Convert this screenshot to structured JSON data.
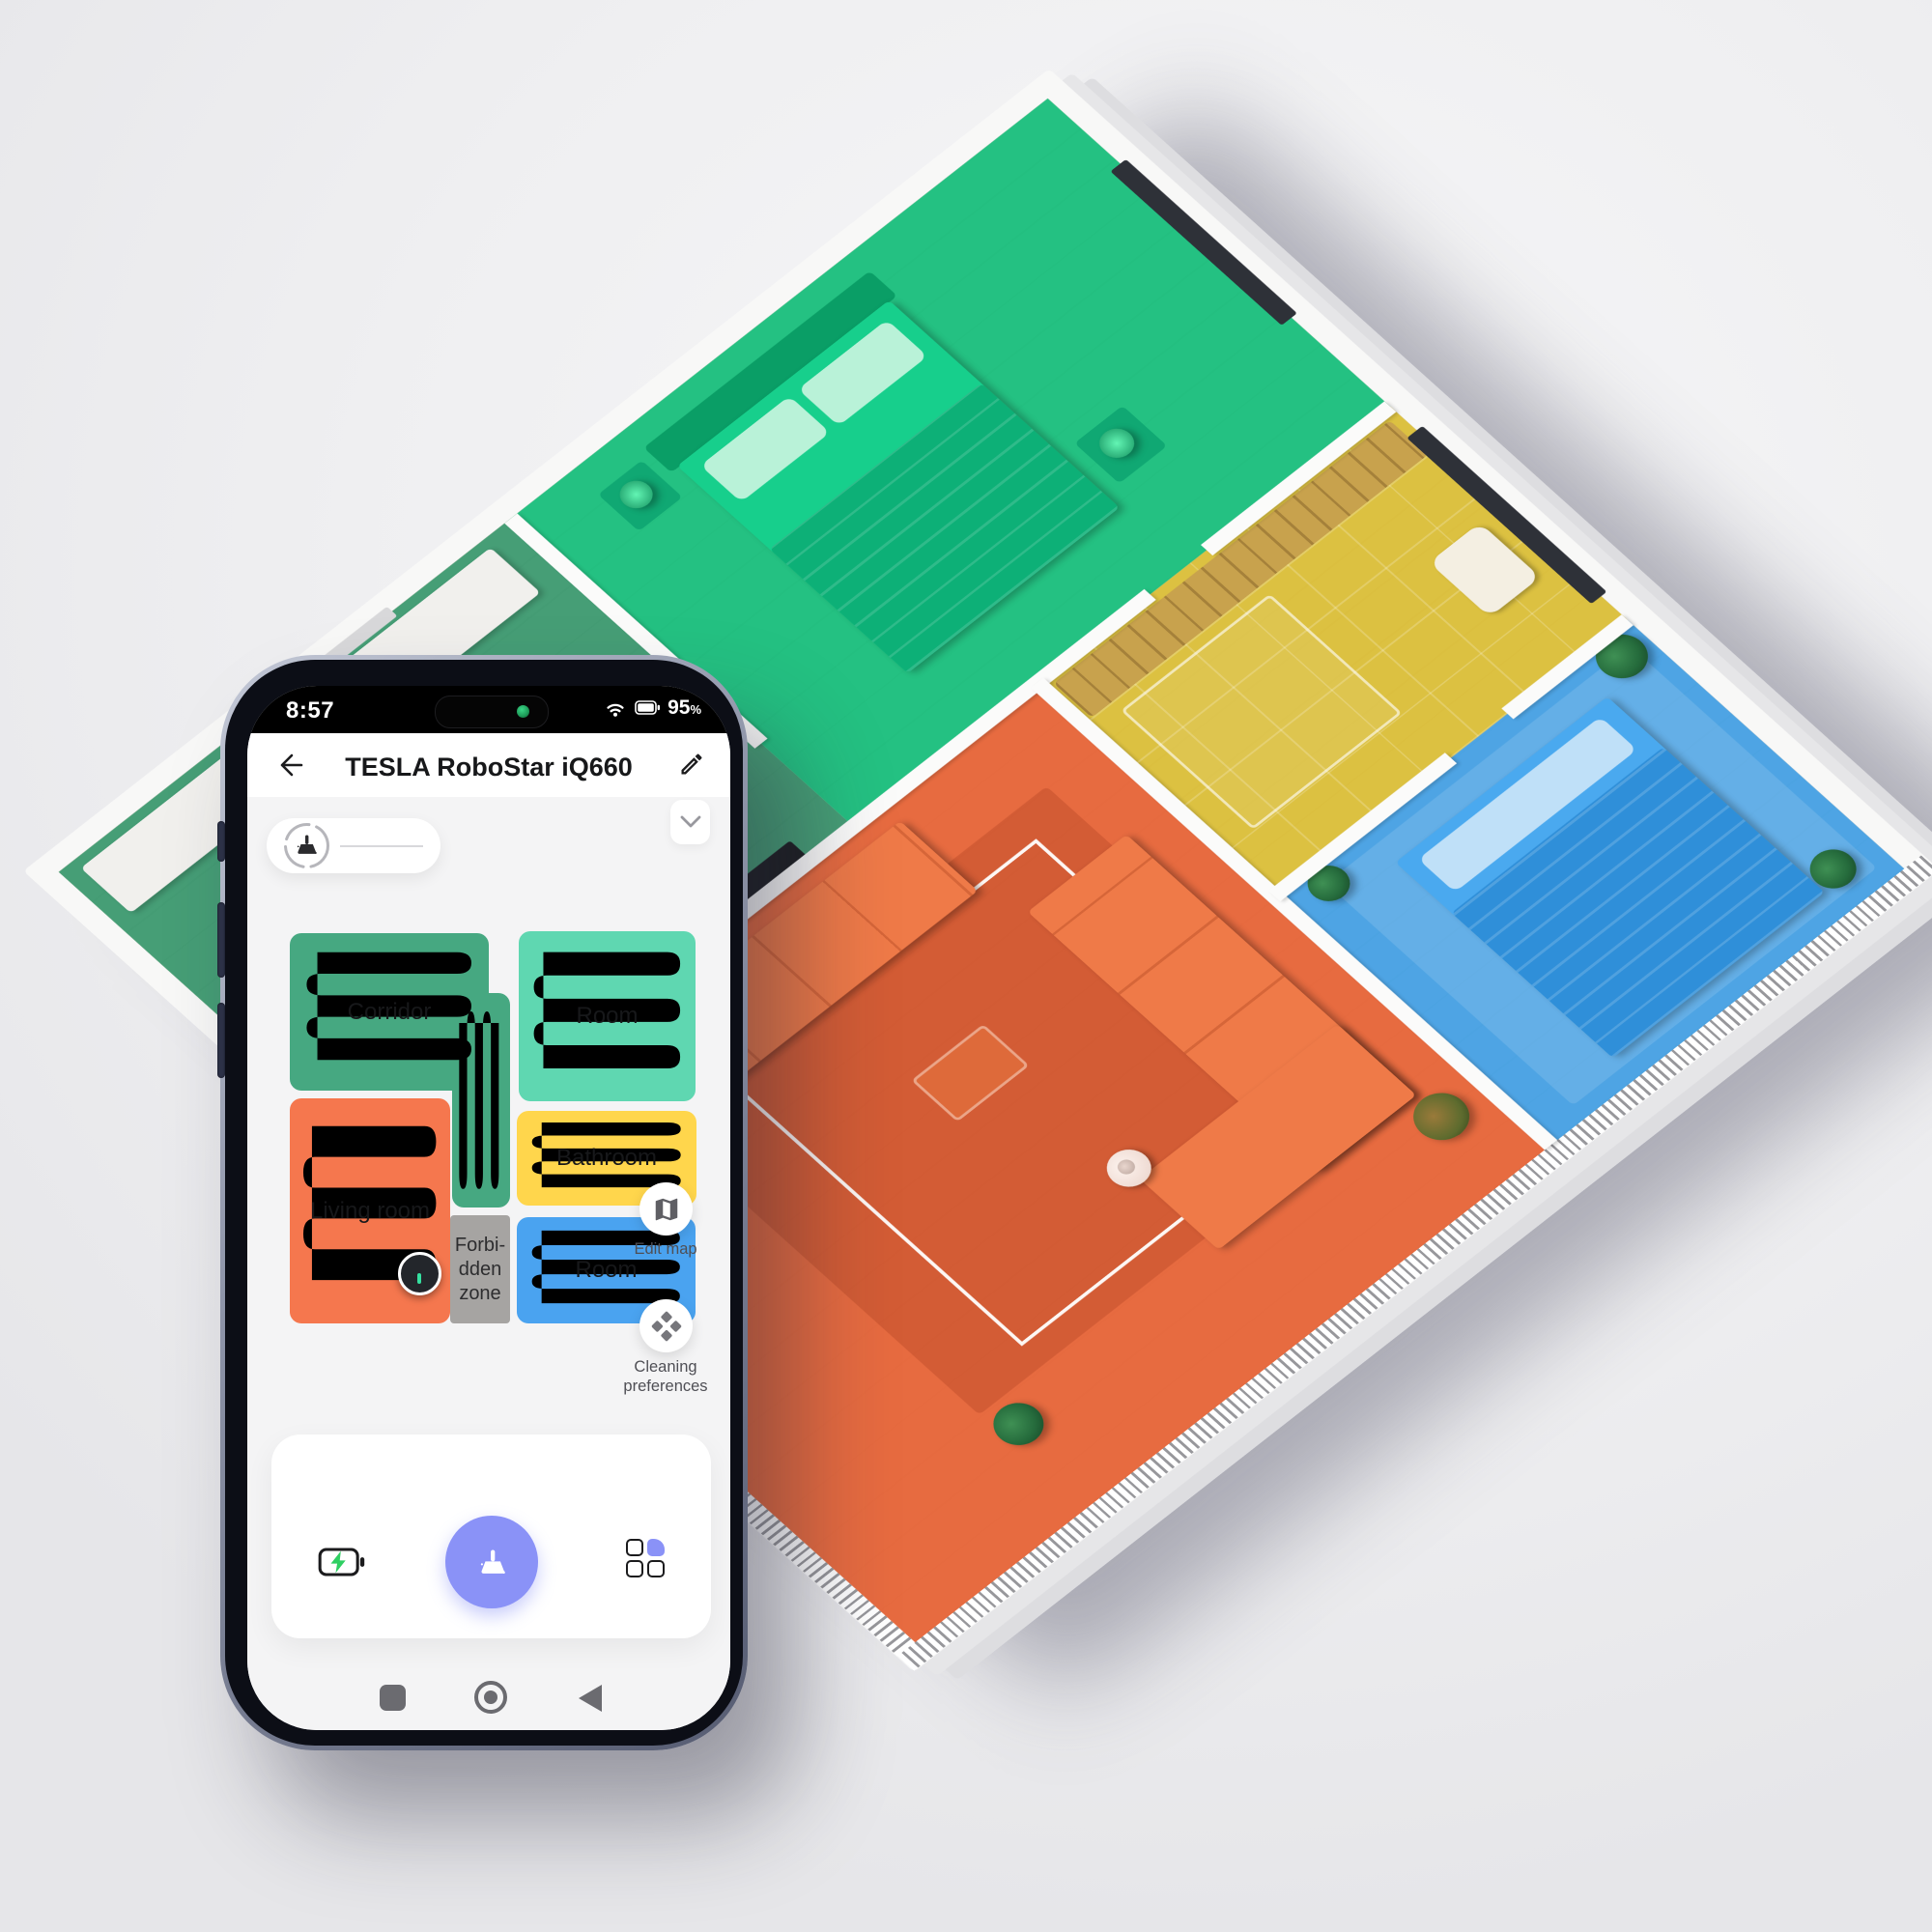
{
  "app": {
    "status_bar": {
      "time": "8:57",
      "battery_value": "95",
      "percent_sign": "%"
    },
    "header": {
      "title": "TESLA RoboStar iQ660"
    },
    "map": {
      "corridor_label": "Corridor",
      "room_top_label": "Room",
      "living_label": "Living room",
      "bathroom_label": "Bathroom",
      "room_right_label": "Room",
      "forbidden_lines": [
        "Forbi-",
        "dden",
        "zone"
      ],
      "edit_map_label": "Edit map",
      "cleaning_preferences_label": "Cleaning preferences"
    },
    "colors": {
      "accent_periwinkle": "#8A92F7",
      "map_corridor_green": "#46A881",
      "map_room_teal": "#5FD7B1",
      "map_living_orange": "#F5774E",
      "map_bathroom_yellow": "#FFD64C",
      "map_room_blue": "#4AA3F0",
      "map_forbidden_gray": "#A6A4A2",
      "robot_marker_tick": "#35E0A0",
      "charge_bolt_green": "#2FCF62",
      "camera_dot_green": "#2EB872"
    }
  },
  "scene": {
    "colors": {
      "bedroom_green": "#0FBF7D",
      "corridor_green": "#2E9B72",
      "bathroom_yellow": "#DDBE2C",
      "bedroom_blue": "#3A9EE9",
      "living_orange": "#E96133"
    }
  }
}
